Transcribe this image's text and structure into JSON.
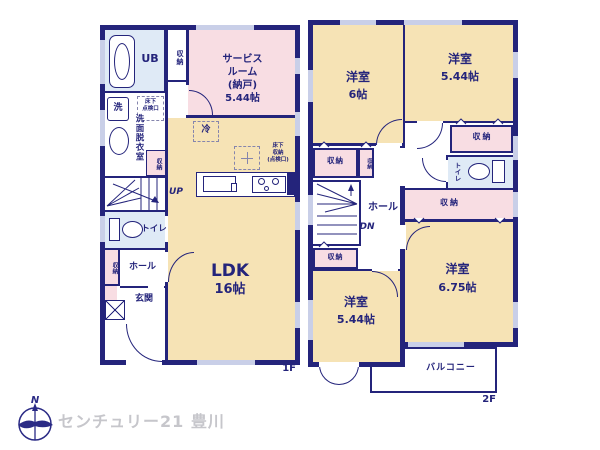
{
  "colors": {
    "wall_navy": "#24247b",
    "room_yellow": "#f6e3b5",
    "room_pink": "#f8dde3",
    "room_blue": "#dfeaf6",
    "window_marker": "#c9cfe8",
    "brand_gray": "#c6c6cb"
  },
  "floor1": {
    "floor_label": "1F",
    "ub": "UB",
    "storage": "収納",
    "service_room": {
      "l1": "サービス",
      "l2": "ルーム",
      "l3": "(納戸)",
      "l4": "5.44帖"
    },
    "washroom": "洗面脱衣室",
    "washer": "洗",
    "hatch": {
      "l1": "床下",
      "l2": "点検口"
    },
    "fridge": "冷",
    "underfloor": {
      "l1": "床下",
      "l2": "収納",
      "l3": "(点検口)"
    },
    "up": "UP",
    "toilet": "トイレ",
    "hall": "ホール",
    "entrance": "玄関",
    "ldk": {
      "name": "LDK",
      "size": "16帖"
    }
  },
  "floor2": {
    "floor_label": "2F",
    "storage": "収納",
    "toilet": "トイレ",
    "hall": "ホール",
    "dn": "DN",
    "room_nw": {
      "name": "洋室",
      "size": "6帖"
    },
    "room_ne": {
      "name": "洋室",
      "size": "5.44帖"
    },
    "room_se": {
      "name": "洋室",
      "size": "6.75帖"
    },
    "room_sw": {
      "name": "洋室",
      "size": "5.44帖"
    },
    "balcony": "バルコニー"
  },
  "footer": {
    "compass_n": "N",
    "brand": "センチュリー21 豊川"
  }
}
